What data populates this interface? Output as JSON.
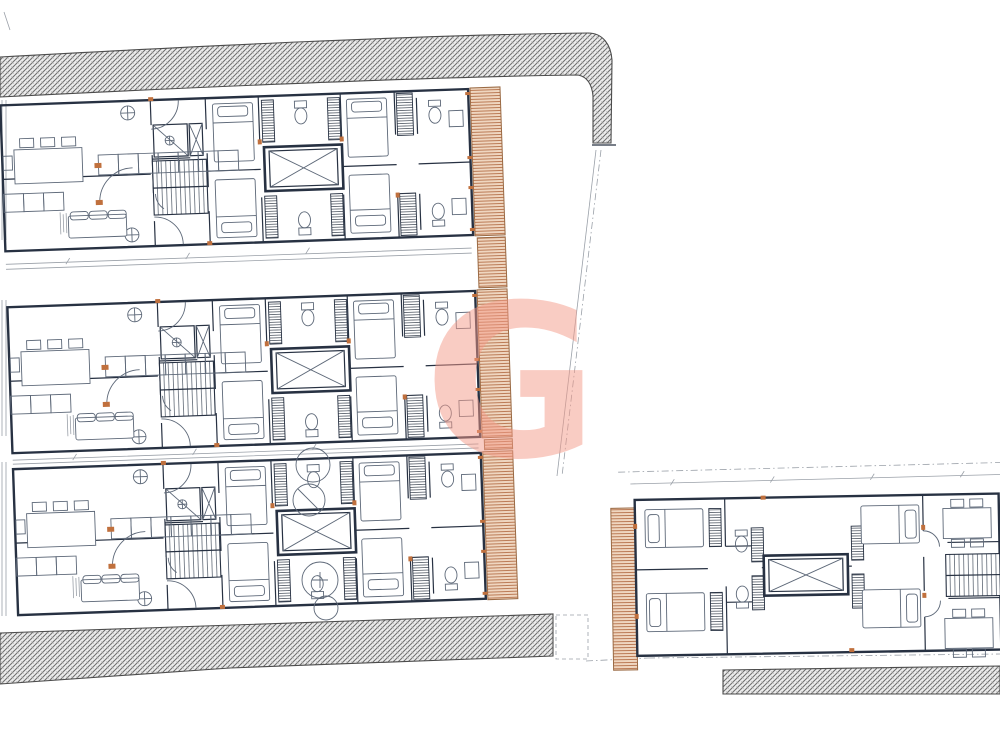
{
  "canvas": {
    "width": 1000,
    "height": 750,
    "background": "#ffffff"
  },
  "palette": {
    "wall": "#273142",
    "furniture": "#5d6878",
    "dimension_line": "#9aa0a8",
    "accent_orange": "#c0703d",
    "site_hatch_line": "#707070",
    "site_hatch_bg": "#ececec",
    "deck_line": "#b5714a",
    "deck_bg": "#efd6c0",
    "watermark": "#f59a88"
  },
  "watermark": {
    "glyph": "G",
    "opacity": "0.5"
  },
  "drawing": {
    "type": "architectural-floor-plan",
    "buildings": [
      {
        "id": "left-block",
        "units": 3,
        "features": [
          "living-dining",
          "kitchen-counter",
          "entry-hall",
          "stairs",
          "shower-room",
          "duct",
          "elevator",
          "bedrooms",
          "bathrooms",
          "wardrobes",
          "balcony-deck"
        ]
      },
      {
        "id": "right-block",
        "units": 1,
        "features": [
          "bedrooms",
          "wardrobes",
          "elevator",
          "bathrooms",
          "corridor",
          "stairs",
          "dining-tables",
          "balcony-deck"
        ]
      }
    ],
    "site_features": [
      "perimeter-hatch-band-top",
      "perimeter-hatch-band-bottom-left",
      "perimeter-hatch-band-bottom-right",
      "plot-boundary-line",
      "setting-out-circles"
    ]
  }
}
